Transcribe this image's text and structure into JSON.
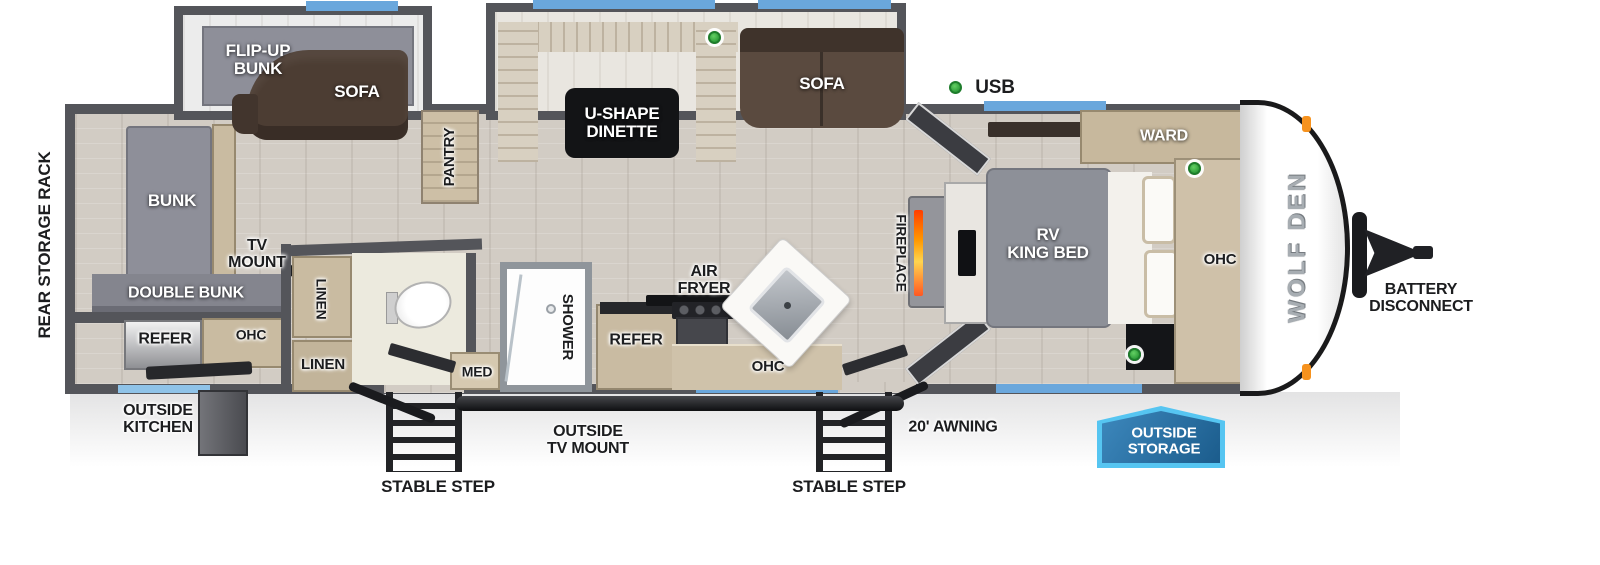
{
  "brand": "WOLF DEN",
  "colors": {
    "wall": "#54555a",
    "floor": "#d2ccc4",
    "window_blue": "#6aa7dc",
    "usb_green": "#2f9e3a",
    "sofa_brown": "#52423a",
    "cabinet_tan": "#c9bba1",
    "badge_fill": "#1b5c8c",
    "badge_border": "#56c5f1",
    "marker_orange": "#f6921e"
  },
  "legend": {
    "usb": "USB"
  },
  "labels": {
    "rear_storage_rack": "REAR STORAGE RACK",
    "flip_up_bunk": "FLIP-UP\nBUNK",
    "sofa_rear": "SOFA",
    "u_shape_dinette": "U-SHAPE\nDINETTE",
    "sofa_main": "SOFA",
    "pantry": "PANTRY",
    "usb": "USB",
    "bunk": "BUNK",
    "tv_mount": "TV\nMOUNT",
    "double_bunk": "DOUBLE BUNK",
    "refer_rear": "REFER",
    "ohc_rear": "OHC",
    "linen_upper": "LINEN",
    "linen_lower": "LINEN",
    "outside_kitchen": "OUTSIDE\nKITCHEN",
    "med": "MED",
    "shower": "SHOWER",
    "refer_kitchen": "REFER",
    "air_fryer": "AIR\nFRYER",
    "ohc_kitchen": "OHC",
    "fireplace": "FIREPLACE",
    "rv_king_bed": "RV\nKING BED",
    "ward": "WARD",
    "ohc_bedroom": "OHC",
    "stable_step_left": "STABLE STEP",
    "stable_step_right": "STABLE STEP",
    "outside_tv_mount": "OUTSIDE\nTV MOUNT",
    "awning": "20' AWNING",
    "outside_storage": "OUTSIDE\nSTORAGE",
    "battery_disconnect": "BATTERY\nDISCONNECT",
    "brand": "WOLF DEN"
  }
}
